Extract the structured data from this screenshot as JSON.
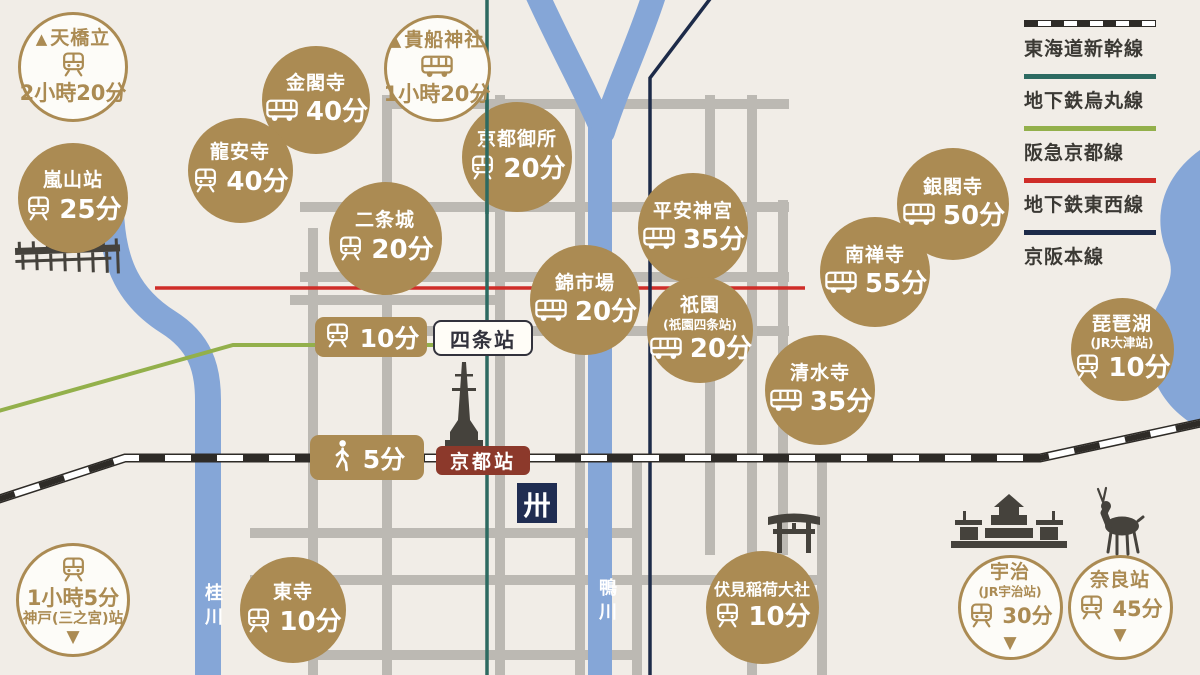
{
  "title": "京都交通アクセスマップ",
  "colors": {
    "bg": "#f1ede7",
    "gold": "#ab8b53",
    "road": "#bcb9b3",
    "river": "#85a6d7",
    "karasuma": "#2d6a61",
    "hankyu": "#93b04b",
    "tozai": "#cf2d28",
    "keihan": "#1d2b49",
    "rail": "#2e2b27",
    "sil": "#45423c",
    "badgered": "#8c392b",
    "navy": "#202d52",
    "labeldark": "#32323c",
    "legendtext": "#3b3934"
  },
  "legend": {
    "items": [
      {
        "label": "東海道新幹線",
        "style": "railway"
      },
      {
        "label": "地下鉄烏丸線",
        "style": "solid",
        "color": "#2d6a61"
      },
      {
        "label": "阪急京都線",
        "style": "solid",
        "color": "#93b04b"
      },
      {
        "label": "地下鉄東西線",
        "style": "solid",
        "color": "#cf2d28"
      },
      {
        "label": "京阪本線",
        "style": "solid",
        "color": "#1d2b49"
      }
    ]
  },
  "spots": [
    {
      "id": "amanohashidate",
      "style": "white",
      "cx": 73,
      "cy": 67,
      "d": 110,
      "label": "天橋立",
      "time": "2小時20分",
      "icon": "train",
      "parts": [
        {
          "t": "name",
          "v": "天橋立",
          "mt": true
        },
        {
          "t": "icon",
          "icon": "train"
        },
        {
          "t": "time",
          "v": "2小時20分"
        }
      ]
    },
    {
      "id": "arashiyama",
      "style": "gold",
      "cx": 73,
      "cy": 198,
      "d": 110,
      "label": "嵐山站",
      "time": "25分",
      "icon": "train",
      "parts": [
        {
          "t": "name",
          "v": "嵐山站"
        },
        {
          "t": "row",
          "icon": "train",
          "v": "25分"
        }
      ]
    },
    {
      "id": "kinkakuji",
      "style": "gold",
      "cx": 316,
      "cy": 100,
      "d": 108,
      "label": "金閣寺",
      "time": "40分",
      "icon": "bus",
      "parts": [
        {
          "t": "name",
          "v": "金閣寺"
        },
        {
          "t": "row",
          "icon": "bus",
          "v": "40分"
        }
      ]
    },
    {
      "id": "kifune",
      "style": "white",
      "cx": 437,
      "cy": 68,
      "d": 107,
      "label": "貴船神社",
      "time": "1小時20分",
      "icon": "bus",
      "parts": [
        {
          "t": "name",
          "v": "貴船神社",
          "mt": true
        },
        {
          "t": "icon",
          "icon": "bus"
        },
        {
          "t": "time",
          "v": "1小時20分"
        }
      ]
    },
    {
      "id": "ryoanji",
      "style": "gold",
      "cx": 240,
      "cy": 170,
      "d": 105,
      "label": "龍安寺",
      "time": "40分",
      "icon": "train",
      "parts": [
        {
          "t": "name",
          "v": "龍安寺"
        },
        {
          "t": "row",
          "icon": "train",
          "v": "40分"
        }
      ]
    },
    {
      "id": "gosho",
      "style": "gold",
      "cx": 517,
      "cy": 157,
      "d": 110,
      "label": "京都御所",
      "time": "20分",
      "icon": "train",
      "parts": [
        {
          "t": "name",
          "v": "京都御所"
        },
        {
          "t": "row",
          "icon": "train",
          "v": "20分"
        }
      ]
    },
    {
      "id": "nijo",
      "style": "gold",
      "cx": 385,
      "cy": 238,
      "d": 113,
      "label": "二条城",
      "time": "20分",
      "icon": "train",
      "parts": [
        {
          "t": "name",
          "v": "二条城"
        },
        {
          "t": "row",
          "icon": "train",
          "v": "20分"
        }
      ]
    },
    {
      "id": "heian",
      "style": "gold",
      "cx": 693,
      "cy": 228,
      "d": 110,
      "label": "平安神宮",
      "time": "35分",
      "icon": "bus",
      "parts": [
        {
          "t": "name",
          "v": "平安神宮"
        },
        {
          "t": "row",
          "icon": "bus",
          "v": "35分"
        }
      ]
    },
    {
      "id": "nishiki",
      "style": "gold",
      "cx": 585,
      "cy": 300,
      "d": 110,
      "label": "錦市場",
      "time": "20分",
      "icon": "bus",
      "parts": [
        {
          "t": "name",
          "v": "錦市場"
        },
        {
          "t": "row",
          "icon": "bus",
          "v": "20分"
        }
      ]
    },
    {
      "id": "gion",
      "style": "gold",
      "cx": 700,
      "cy": 330,
      "d": 106,
      "label": "祇園",
      "sub": "(祇園四条站)",
      "time": "20分",
      "icon": "bus",
      "parts": [
        {
          "t": "name",
          "v": "祇園"
        },
        {
          "t": "sub",
          "v": "(祇園四条站)"
        },
        {
          "t": "row",
          "icon": "bus",
          "v": "20分"
        }
      ]
    },
    {
      "id": "nanzenji",
      "style": "gold",
      "cx": 875,
      "cy": 272,
      "d": 110,
      "label": "南禅寺",
      "time": "55分",
      "icon": "bus",
      "parts": [
        {
          "t": "name",
          "v": "南禅寺"
        },
        {
          "t": "row",
          "icon": "bus",
          "v": "55分"
        }
      ]
    },
    {
      "id": "ginkakuji",
      "style": "gold",
      "cx": 953,
      "cy": 204,
      "d": 112,
      "label": "銀閣寺",
      "time": "50分",
      "icon": "bus",
      "parts": [
        {
          "t": "name",
          "v": "銀閣寺"
        },
        {
          "t": "row",
          "icon": "bus",
          "v": "50分"
        }
      ]
    },
    {
      "id": "kiyomizu",
      "style": "gold",
      "cx": 820,
      "cy": 390,
      "d": 110,
      "label": "清水寺",
      "time": "35分",
      "icon": "bus",
      "parts": [
        {
          "t": "name",
          "v": "清水寺"
        },
        {
          "t": "row",
          "icon": "bus",
          "v": "35分"
        }
      ]
    },
    {
      "id": "biwako",
      "style": "gold",
      "cx": 1122,
      "cy": 349,
      "d": 103,
      "label": "琵琶湖",
      "sub": "(JR大津站)",
      "time": "10分",
      "icon": "train",
      "parts": [
        {
          "t": "name",
          "v": "琵琶湖"
        },
        {
          "t": "sub",
          "v": "(JR大津站)"
        },
        {
          "t": "row",
          "icon": "train",
          "v": "10分"
        }
      ]
    },
    {
      "id": "toji",
      "style": "gold",
      "cx": 293,
      "cy": 610,
      "d": 106,
      "label": "東寺",
      "time": "10分",
      "icon": "train",
      "parts": [
        {
          "t": "name",
          "v": "東寺"
        },
        {
          "t": "row",
          "icon": "train",
          "v": "10分"
        }
      ]
    },
    {
      "id": "fushimi",
      "style": "gold",
      "cx": 762,
      "cy": 607,
      "d": 113,
      "label": "伏見稲荷大社",
      "time": "10分",
      "icon": "train",
      "parts": [
        {
          "t": "name",
          "v": "伏見稲荷大社"
        },
        {
          "t": "row",
          "icon": "train",
          "v": "10分"
        }
      ]
    },
    {
      "id": "kobe",
      "style": "white",
      "cx": 73,
      "cy": 600,
      "d": 114,
      "label": "神戸(三之宮)站",
      "time": "1小時5分",
      "icon": "train",
      "parts": [
        {
          "t": "icon",
          "icon": "train"
        },
        {
          "t": "time",
          "v": "1小時5分"
        },
        {
          "t": "name2",
          "v": "神戸(三之宮)站"
        },
        {
          "t": "tri"
        }
      ]
    },
    {
      "id": "uji",
      "style": "white",
      "cx": 1010,
      "cy": 607,
      "d": 105,
      "label": "宇治",
      "sub": "(JR宇治站)",
      "time": "30分",
      "icon": "train",
      "parts": [
        {
          "t": "name",
          "v": "宇治"
        },
        {
          "t": "sub",
          "v": "(JR宇治站)"
        },
        {
          "t": "row",
          "icon": "train",
          "v": "30分"
        },
        {
          "t": "tri"
        }
      ]
    },
    {
      "id": "nara",
      "style": "white",
      "cx": 1120,
      "cy": 607,
      "d": 105,
      "label": "奈良站",
      "time": "45分",
      "icon": "train",
      "parts": [
        {
          "t": "name",
          "v": "奈良站"
        },
        {
          "t": "row",
          "icon": "train",
          "v": "45分"
        },
        {
          "t": "tri"
        }
      ]
    }
  ],
  "badges": {
    "shijo_time": {
      "time": "10分",
      "icon": "train"
    },
    "shijo_station": "四条站",
    "kyoto_walk": {
      "time": "5分",
      "icon": "walk"
    },
    "kyoto_station": "京都站",
    "temple_mark": "卅"
  },
  "rivers": {
    "katsura": "桂川",
    "kamo": "鴨川"
  },
  "arrow_glyphs": {
    "mountain": "▲",
    "down": "▼"
  }
}
